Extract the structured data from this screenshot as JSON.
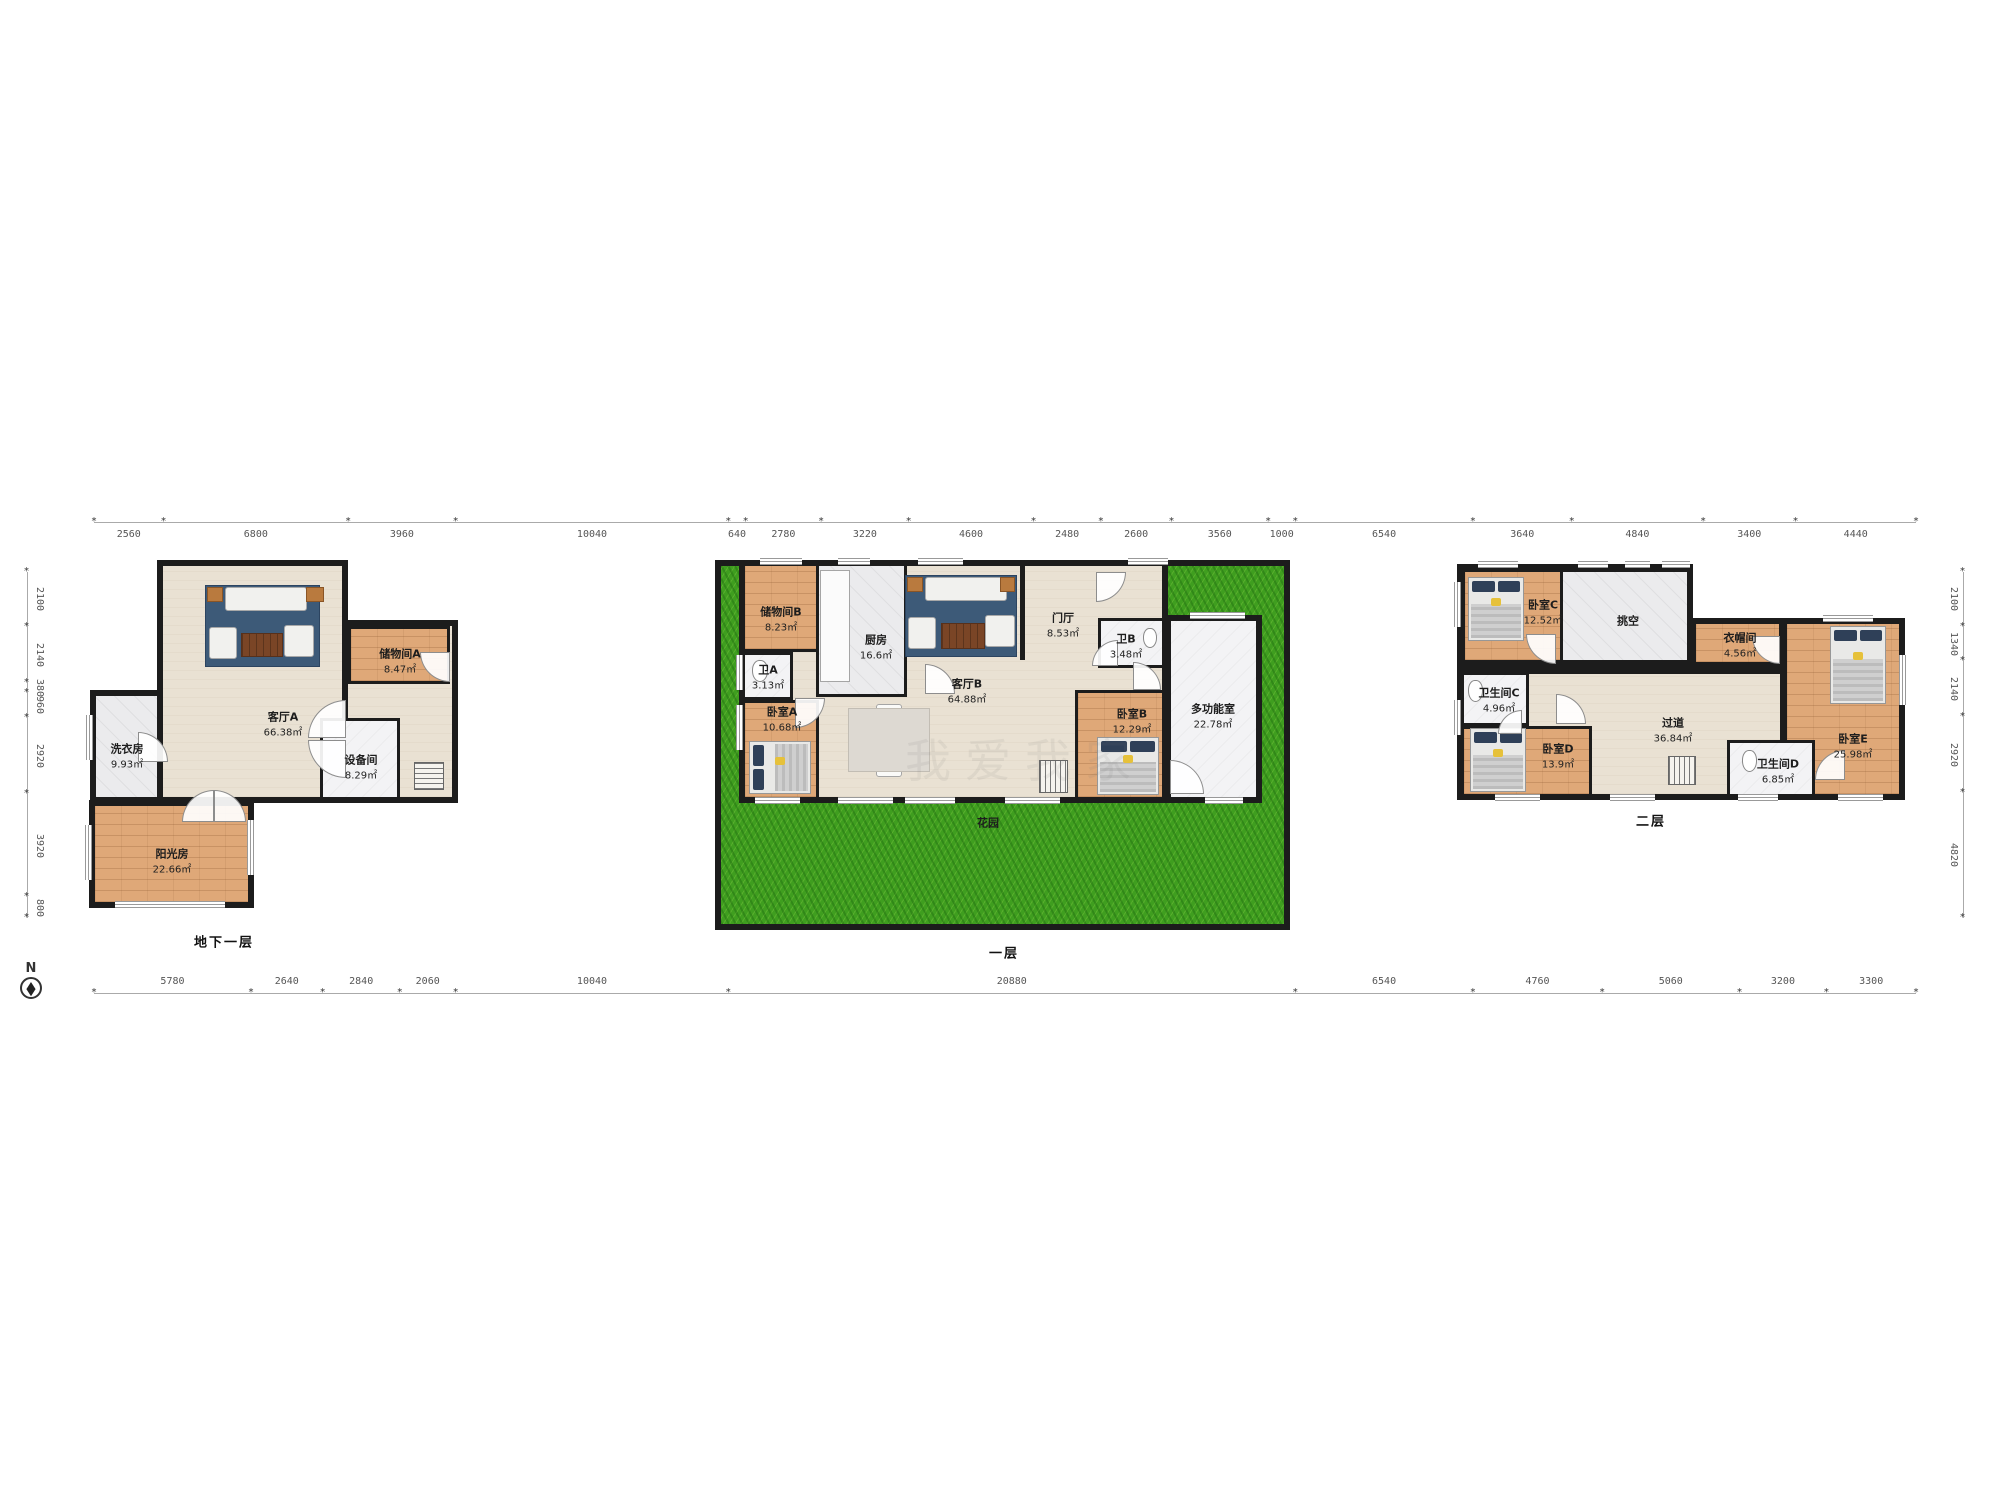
{
  "compass": {
    "label": "N"
  },
  "watermark": "我爱我家",
  "rulers": {
    "top": [
      2560,
      6800,
      3960,
      10040,
      640,
      2780,
      3220,
      4600,
      2480,
      2600,
      3560,
      1000,
      6540,
      3640,
      4840,
      3400,
      4440
    ],
    "bottom": [
      5780,
      2640,
      2840,
      2060,
      10040,
      20880,
      6540,
      4760,
      5060,
      3200,
      3300
    ],
    "left": [
      2100,
      2140,
      380,
      960,
      2920,
      3920,
      800
    ],
    "right": [
      2100,
      1340,
      2140,
      2920,
      4820
    ]
  },
  "floors": [
    {
      "caption": "地下一层",
      "rooms": [
        {
          "name": "客厅A",
          "area": "66.38㎡"
        },
        {
          "name": "储物间A",
          "area": "8.47㎡"
        },
        {
          "name": "洗衣房",
          "area": "9.93㎡"
        },
        {
          "name": "设备间",
          "area": "8.29㎡"
        },
        {
          "name": "阳光房",
          "area": "22.66㎡"
        }
      ]
    },
    {
      "caption": "一层",
      "rooms": [
        {
          "name": "储物间B",
          "area": "8.23㎡"
        },
        {
          "name": "厨房",
          "area": "16.6㎡"
        },
        {
          "name": "客厅B",
          "area": "64.88㎡"
        },
        {
          "name": "卫A",
          "area": "3.13㎡"
        },
        {
          "name": "卧室A",
          "area": "10.68㎡"
        },
        {
          "name": "门厅",
          "area": "8.53㎡"
        },
        {
          "name": "卫B",
          "area": "3.48㎡"
        },
        {
          "name": "卧室B",
          "area": "12.29㎡"
        },
        {
          "name": "多功能室",
          "area": "22.78㎡"
        },
        {
          "name": "花园",
          "area": ""
        }
      ]
    },
    {
      "caption": "二层",
      "rooms": [
        {
          "name": "卧室C",
          "area": "12.52㎡"
        },
        {
          "name": "挑空",
          "area": ""
        },
        {
          "name": "衣帽间",
          "area": "4.56㎡"
        },
        {
          "name": "卫生间C",
          "area": "4.96㎡"
        },
        {
          "name": "卧室D",
          "area": "13.9㎡"
        },
        {
          "name": "过道",
          "area": "36.84㎡"
        },
        {
          "name": "卫生间D",
          "area": "6.85㎡"
        },
        {
          "name": "卧室E",
          "area": "25.98㎡"
        }
      ]
    }
  ],
  "colors": {
    "wall": "#1c1c1c",
    "wood_floor": "#dfa878",
    "beige_floor": "#e9e1d3",
    "tile_floor": "#ebebed",
    "grass": "#3f9e1f",
    "rug": "#3d5a78",
    "pillow": "#2f4058"
  }
}
